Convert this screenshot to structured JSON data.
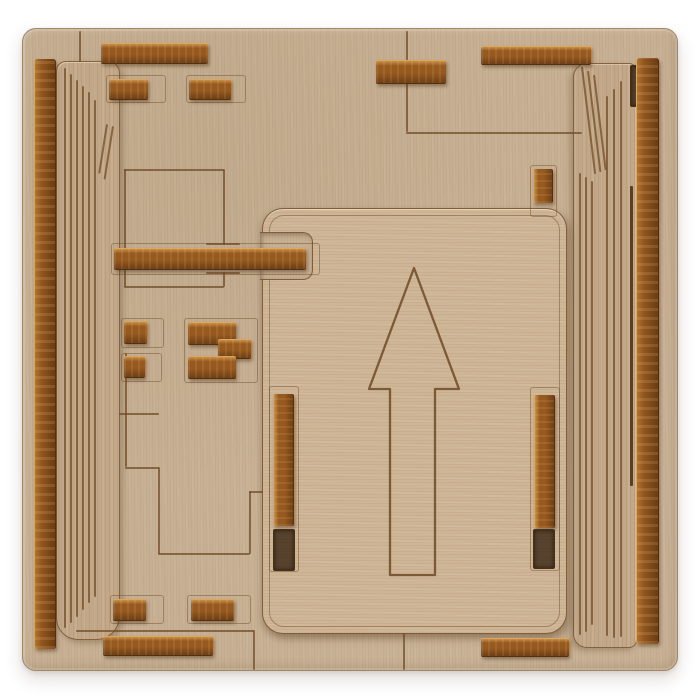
{
  "scene": {
    "description": "Top-down product photo of a laser-cut plywood sliding-block puzzle on a white background. A light wooden base board holds two tall grooved side panels, many small dark-stained wooden slider strips, and a large central rounded plate engraved with an upward-pointing arrow.",
    "background": "#ffffff",
    "colors": {
      "white_bg": "#ffffff",
      "base": "#c6af92",
      "panel": "#c2a888",
      "plate": "#cdb596",
      "engrave": "#6f4a24",
      "slot_line": "#4a2d12",
      "board_border": "#a18866",
      "strip_hi": "#c98f46",
      "strip_mid": "#96591f",
      "strip_dark": "#6e3f16",
      "strip_edge": "#d9a75f"
    },
    "board": {
      "x": 22,
      "y": 28,
      "w": 654,
      "h": 641,
      "radius": 14
    },
    "panels": [
      {
        "name": "left-side-panel",
        "cls": "panel-left",
        "x": 55,
        "y": 60,
        "w": 62,
        "h": 577,
        "radius": "10px 12px 24px 22px"
      },
      {
        "name": "right-side-panel",
        "cls": "panel-right",
        "x": 572,
        "y": 62,
        "w": 62,
        "h": 583,
        "radius": "14px 8px 8px 14px"
      }
    ],
    "plate": {
      "name": "center-arrow-plate",
      "x": 261,
      "y": 207,
      "w": 303,
      "h": 424,
      "radius": 21
    },
    "notch": {
      "name": "plate-bar-notch",
      "x": 259,
      "y": 231,
      "w": 52,
      "h": 46
    },
    "arrow": {
      "name": "up-arrow-engraving",
      "points": "151,59 106,180 127,180 127,366 172,366 172,180 196,180"
    },
    "strips": [
      {
        "name": "top-left-long-strip",
        "x": 100,
        "y": 42,
        "w": 107,
        "h": 19,
        "o": "h"
      },
      {
        "name": "top-small-strip-1",
        "x": 108,
        "y": 78,
        "w": 39,
        "h": 19,
        "o": "h"
      },
      {
        "name": "top-small-strip-2",
        "x": 188,
        "y": 78,
        "w": 42,
        "h": 19,
        "o": "h"
      },
      {
        "name": "top-center-strip",
        "x": 375,
        "y": 59,
        "w": 70,
        "h": 22,
        "o": "h"
      },
      {
        "name": "top-right-long-strip",
        "x": 480,
        "y": 45,
        "w": 110,
        "h": 17,
        "o": "h"
      },
      {
        "name": "upper-right-small-strip",
        "x": 532,
        "y": 168,
        "w": 18,
        "h": 34,
        "o": "v"
      },
      {
        "name": "left-edge-tall-strip",
        "x": 33,
        "y": 58,
        "w": 20,
        "h": 590,
        "o": "v",
        "variant": "tall"
      },
      {
        "name": "right-edge-tall-strip",
        "x": 635,
        "y": 57,
        "w": 21,
        "h": 586,
        "o": "v",
        "variant": "tall"
      },
      {
        "name": "horizontal-slider-bar",
        "x": 113,
        "y": 247,
        "w": 192,
        "h": 20,
        "o": "h"
      },
      {
        "name": "mid-left-strip-1",
        "x": 123,
        "y": 320,
        "w": 23,
        "h": 21,
        "o": "h"
      },
      {
        "name": "mid-left-strip-2",
        "x": 123,
        "y": 355,
        "w": 21,
        "h": 20,
        "o": "h"
      },
      {
        "name": "z-piece-top",
        "x": 187,
        "y": 321,
        "w": 48,
        "h": 21,
        "o": "h"
      },
      {
        "name": "z-piece-middle",
        "x": 217,
        "y": 338,
        "w": 33,
        "h": 18,
        "o": "h"
      },
      {
        "name": "z-piece-bottom",
        "x": 187,
        "y": 355,
        "w": 48,
        "h": 21,
        "o": "h"
      },
      {
        "name": "plate-left-rail",
        "x": 272,
        "y": 393,
        "w": 19,
        "h": 132,
        "o": "v"
      },
      {
        "name": "plate-right-rail",
        "x": 533,
        "y": 394,
        "w": 19,
        "h": 133,
        "o": "v"
      },
      {
        "name": "bottom-small-strip-1",
        "x": 112,
        "y": 598,
        "w": 33,
        "h": 20,
        "o": "h"
      },
      {
        "name": "bottom-small-strip-2",
        "x": 190,
        "y": 598,
        "w": 43,
        "h": 20,
        "o": "h"
      },
      {
        "name": "bottom-left-long-strip",
        "x": 102,
        "y": 635,
        "w": 110,
        "h": 18,
        "o": "h"
      },
      {
        "name": "bottom-right-strip",
        "x": 480,
        "y": 637,
        "w": 88,
        "h": 17,
        "o": "h"
      }
    ],
    "engraved_lines": [
      [
        405,
        30,
        101,
        "v"
      ],
      [
        405,
        131,
        176,
        "h"
      ],
      [
        78,
        30,
        31,
        "v"
      ],
      [
        123,
        168,
        100,
        "h"
      ],
      [
        123,
        168,
        118,
        "v"
      ],
      [
        222,
        168,
        76,
        "v"
      ],
      [
        222,
        271,
        15,
        "v"
      ],
      [
        123,
        285,
        100,
        "h"
      ],
      [
        124,
        352,
        114,
        "v"
      ],
      [
        124,
        466,
        34,
        "h"
      ],
      [
        157,
        466,
        87,
        "v"
      ],
      [
        157,
        552,
        92,
        "h"
      ],
      [
        248,
        490,
        63,
        "v"
      ],
      [
        248,
        490,
        14,
        "h"
      ],
      [
        118,
        412,
        40,
        "h"
      ],
      [
        75,
        629,
        178,
        "h"
      ],
      [
        252,
        629,
        40,
        "v"
      ],
      [
        402,
        632,
        37,
        "v"
      ],
      [
        205,
        242,
        34,
        "h"
      ],
      [
        205,
        271,
        34,
        "h"
      ],
      [
        63,
        67,
        560,
        "v"
      ],
      [
        69,
        73,
        549,
        "v"
      ],
      [
        75,
        79,
        537,
        "v"
      ],
      [
        81,
        85,
        524,
        "v"
      ],
      [
        87,
        91,
        511,
        "v"
      ],
      [
        93,
        99,
        497,
        "v"
      ],
      [
        111,
        125,
        54,
        "v",
        9
      ],
      [
        105,
        123,
        50,
        "v",
        9
      ],
      [
        578,
        172,
        462,
        "v"
      ],
      [
        584,
        176,
        455,
        "v"
      ],
      [
        590,
        180,
        444,
        "v"
      ],
      [
        605,
        95,
        540,
        "v"
      ],
      [
        612,
        88,
        549,
        "v"
      ],
      [
        619,
        80,
        556,
        "v"
      ],
      [
        580,
        66,
        108,
        "v",
        -7
      ],
      [
        586,
        70,
        102,
        "v",
        -7
      ],
      [
        592,
        74,
        96,
        "v",
        -7
      ],
      [
        629,
        185,
        300,
        "v",
        0,
        3,
        "slot_line"
      ],
      [
        562,
        45,
        17,
        "v",
        0,
        1.4,
        "slot_line"
      ]
    ],
    "slot_outlines": [
      [
        105,
        74,
        58,
        26
      ],
      [
        185,
        74,
        58,
        26
      ],
      [
        120,
        317,
        41,
        28
      ],
      [
        120,
        352,
        39,
        27
      ],
      [
        183,
        317,
        72,
        63
      ],
      [
        109,
        594,
        52,
        27
      ],
      [
        186,
        594,
        62,
        27
      ],
      [
        268,
        385,
        28,
        184
      ],
      [
        529,
        386,
        28,
        182
      ],
      [
        529,
        164,
        25,
        50
      ],
      [
        110,
        242,
        207,
        30
      ]
    ],
    "slot_cutouts": [
      [
        272,
        528,
        20,
        40
      ],
      [
        532,
        528,
        20,
        38
      ],
      [
        629,
        64,
        8,
        40
      ]
    ]
  }
}
